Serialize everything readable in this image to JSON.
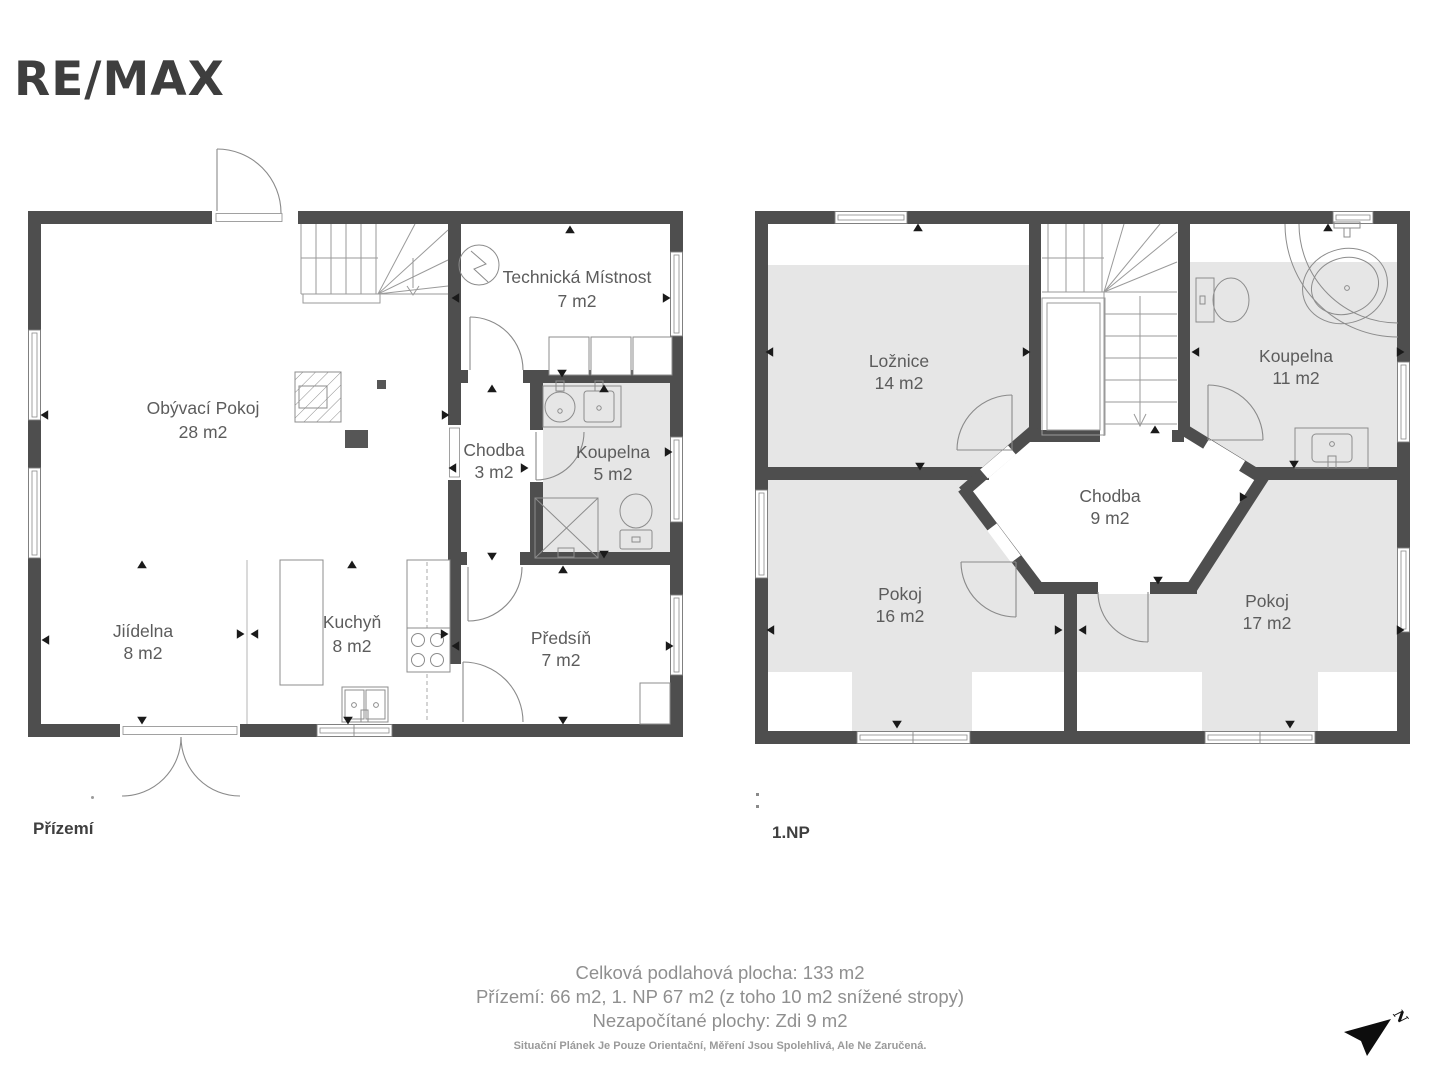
{
  "brand": {
    "logo": "RE/MAX"
  },
  "floors": [
    {
      "id": "ground",
      "label": "Přízemí",
      "rooms": [
        {
          "name": "Obývací Pokoj",
          "area": "28 m2"
        },
        {
          "name": "Technická Místnost",
          "area": "7 m2"
        },
        {
          "name": "Chodba",
          "area": "3 m2"
        },
        {
          "name": "Koupelna",
          "area": "5 m2"
        },
        {
          "name": "Jiídelna",
          "area": "8 m2"
        },
        {
          "name": "Kuchyň",
          "area": "8 m2"
        },
        {
          "name": "Předsíň",
          "area": "7 m2"
        }
      ]
    },
    {
      "id": "first",
      "label": "1.NP",
      "rooms": [
        {
          "name": "Ložnice",
          "area": "14 m2"
        },
        {
          "name": "Koupelna",
          "area": "11 m2"
        },
        {
          "name": "Chodba",
          "area": "9 m2"
        },
        {
          "name": "Pokoj",
          "area": "16 m2"
        },
        {
          "name": "Pokoj",
          "area": "17 m2"
        }
      ]
    }
  ],
  "summary": {
    "total": "Celková podlahová plocha: 133 m2",
    "per_floor": "Přízemí: 66 m2, 1. NP 67 m2 (z toho 10 m2 snížené stropy)",
    "excluded": "Nezapočítané plochy: Zdi 9 m2",
    "disclaimer": "Situační Plánek Je Pouze Orientační, Měření Jsou Spolehlivá, Ale Ne Zaručená."
  },
  "compass": {
    "label": "N"
  },
  "colors": {
    "wall": "#4e4e4e",
    "room_shade": "#e6e6e6",
    "label_text": "#5c5c5c",
    "logo": "#3e3e3e",
    "footer_text": "#8f8f8f"
  }
}
